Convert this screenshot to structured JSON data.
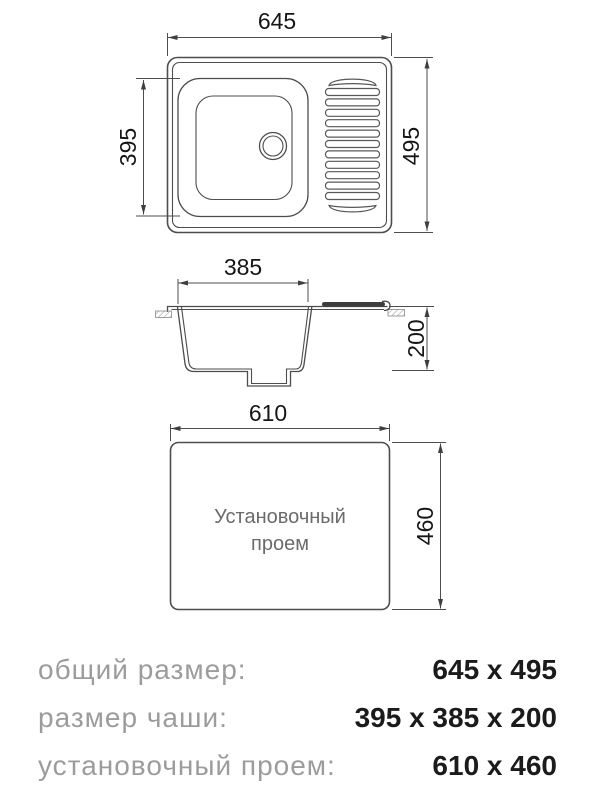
{
  "views": {
    "top": {
      "width_label": "645",
      "height_label": "495",
      "bowl_height_label": "395"
    },
    "section": {
      "bowl_width_label": "385",
      "depth_label": "200"
    },
    "install": {
      "width_label": "610",
      "height_label": "460",
      "label_line1": "Установочный",
      "label_line2": "проем"
    }
  },
  "table": {
    "rows": [
      {
        "label": "общий размер:",
        "value": "645 x 495"
      },
      {
        "label": "размер чаши:",
        "value": "395 x 385 x 200"
      },
      {
        "label": "установочный проем:",
        "value": "610 x 460"
      }
    ]
  },
  "colors": {
    "line": "#4d4d4d",
    "dimension_text": "#161616",
    "install_text": "#6b6b6b",
    "label_text": "#9c9c9c",
    "value_text": "#1b1b1b",
    "background": "#ffffff"
  }
}
